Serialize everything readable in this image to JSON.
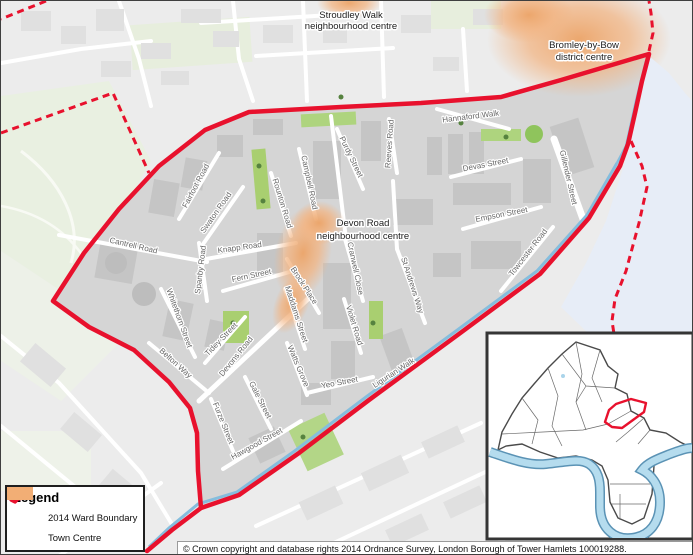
{
  "map": {
    "centre_labels": [
      {
        "line1": "Stroudley Walk",
        "line2": "neighbourhood centre"
      },
      {
        "line1": "Bromley-by-Bow",
        "line2": "district centre"
      },
      {
        "line1": "Devon Road",
        "line2": "neighbourhood centre"
      }
    ],
    "streets": [
      "Cantrell Road",
      "Fairfoot Road",
      "Swaton Road",
      "Knapp Road",
      "Spanby Road",
      "Fern Street",
      "Whitethorn Street",
      "Tidey Street",
      "Belton Way",
      "Devons Road",
      "Gale Street",
      "Furze Street",
      "Hawgood Street",
      "Maddams Street",
      "Watts Grove",
      "Brock Place",
      "Rounton Road",
      "Campbell Road",
      "Purdy Street",
      "Cranwell Close",
      "Violet Road",
      "Yeo Street",
      "Ligurian Walk",
      "St Andrews Way",
      "Reeves Road",
      "Hannaford Walk",
      "Devas Street",
      "Empson Street",
      "Gillender Street",
      "Towcester Road"
    ]
  },
  "legend": {
    "title": "Legend",
    "items": [
      {
        "label": "2014 Ward Boundary"
      },
      {
        "label": "Town Centre"
      }
    ]
  },
  "copyright": "© Crown copyright and database rights 2014 Ordnance Survey, London Borough of Tower Hamlets 100019288.",
  "colors": {
    "ward_boundary": "#e8112d",
    "town_centre": "#f2ae75",
    "canal": "#85bddd",
    "river_area": "#e7edf7"
  }
}
